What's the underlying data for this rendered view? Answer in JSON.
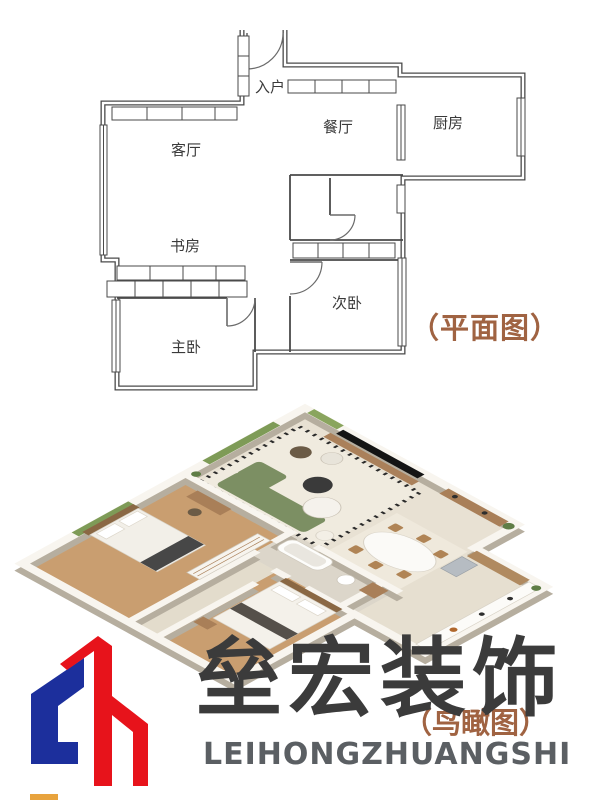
{
  "floor_plan": {
    "caption": "（平面图）",
    "caption_color": "#a06342",
    "rooms": [
      {
        "id": "entry",
        "label": "入户"
      },
      {
        "id": "dining",
        "label": "餐厅"
      },
      {
        "id": "kitchen",
        "label": "厨房"
      },
      {
        "id": "living",
        "label": "客厅"
      },
      {
        "id": "study",
        "label": "书房"
      },
      {
        "id": "secondary-bedroom",
        "label": "次卧"
      },
      {
        "id": "master-bedroom",
        "label": "主卧"
      }
    ],
    "wall_color": "#4a4a4a"
  },
  "render_view": {
    "caption": "（鸟瞰图）",
    "caption_color": "#a06342",
    "floor_color": "#e8e1d3",
    "wood_color": "#c99e70",
    "wall_color": "#f8f5ef",
    "sofa_color": "#7c8f63"
  },
  "logo": {
    "cn": "垒宏装饰",
    "en": "LEIHONGZHUANGSHI",
    "blue": "#1c2f9c",
    "red": "#e7131b",
    "cn_color": "#3b3b3b",
    "en_color": "#5b5f63"
  }
}
